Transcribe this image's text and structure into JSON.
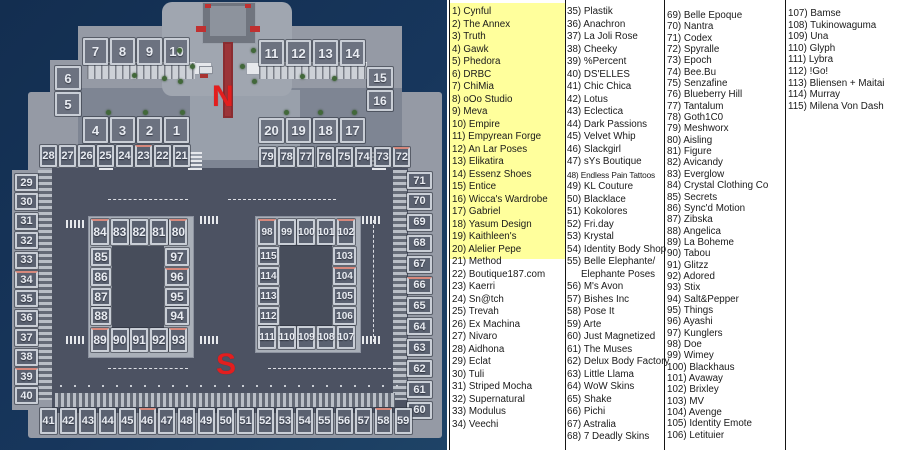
{
  "colors": {
    "water": "#16365c",
    "platform": "#959aa5",
    "road": "#4c5262",
    "plot_fill": "#5a6170",
    "plot_border": "#c9ced6",
    "plot_text": "#e9ecf2",
    "accent_salmon": "#d6887c",
    "highlight_yellow": "#ffff9c",
    "label_red": "#e31e1e",
    "panel_bg": "#ffffff",
    "text": "#1a1a1a"
  },
  "map": {
    "north_label": "N",
    "south_label": "S",
    "plot_groups": [
      {
        "nums": [
          "7",
          "8",
          "9",
          "10"
        ],
        "x": 83,
        "y": 38,
        "dx": 27,
        "w": 25,
        "h": 27,
        "fs": 13,
        "fill": "#6c7280"
      },
      {
        "nums": [
          "11",
          "12",
          "13",
          "14"
        ],
        "x": 259,
        "y": 40,
        "dx": 27,
        "w": 25,
        "h": 26,
        "fs": 13,
        "fill": "#6c7280"
      },
      {
        "nums": [
          "6",
          "5"
        ],
        "x": 55,
        "y": 66,
        "dy": 26,
        "w": 26,
        "h": 24,
        "fs": 13,
        "fill": "#6c7280"
      },
      {
        "nums": [
          "15",
          "16"
        ],
        "x": 367,
        "y": 67,
        "dy": 23,
        "w": 26,
        "h": 21,
        "fs": 12,
        "fill": "#6c7280"
      },
      {
        "nums": [
          "4",
          "3",
          "2",
          "1"
        ],
        "x": 83,
        "y": 117,
        "dx": 27,
        "w": 25,
        "h": 26,
        "fs": 13,
        "fill": "#6c7280"
      },
      {
        "nums": [
          "20",
          "19",
          "18",
          "17"
        ],
        "x": 259,
        "y": 118,
        "dx": 27,
        "w": 25,
        "h": 25,
        "fs": 13,
        "fill": "#6c7280"
      },
      {
        "nums": [
          "28",
          "27",
          "26",
          "25",
          "24",
          "23",
          "22",
          "21"
        ],
        "x": 40,
        "y": 145,
        "dx": 19,
        "w": 17,
        "h": 22,
        "fs": 11
      },
      {
        "nums": [
          "79",
          "78",
          "77",
          "76",
          "75",
          "74",
          "73",
          "72"
        ],
        "x": 259,
        "y": 147,
        "dx": 19.2,
        "w": 17,
        "h": 20,
        "fs": 11
      },
      {
        "nums": [
          "29",
          "30",
          "31",
          "32",
          "33",
          "34",
          "35",
          "36",
          "37",
          "38",
          "39",
          "40"
        ],
        "x": 15,
        "y": 174,
        "dy": 19.4,
        "w": 23,
        "h": 17,
        "fs": 11
      },
      {
        "nums": [
          "71",
          "70",
          "69",
          "68",
          "67",
          "66",
          "65",
          "64",
          "63",
          "62",
          "61",
          "60"
        ],
        "x": 407,
        "y": 172,
        "dy": 20.9,
        "w": 25,
        "h": 17,
        "fs": 11
      },
      {
        "nums": [
          "41",
          "42",
          "43",
          "44",
          "45",
          "46",
          "47",
          "48",
          "49",
          "50",
          "51",
          "52",
          "53",
          "54",
          "55",
          "56",
          "57",
          "58",
          "59"
        ],
        "x": 40,
        "y": 408,
        "dx": 19.7,
        "w": 17,
        "h": 26,
        "fs": 11
      },
      {
        "nums": [
          "84",
          "83",
          "82",
          "81",
          "80"
        ],
        "x": 91,
        "y": 219,
        "dx": 19.6,
        "w": 18,
        "h": 26,
        "fs": 12
      },
      {
        "nums": [
          "85",
          "86",
          "87",
          "88"
        ],
        "x": 91,
        "y": 248,
        "dy": 19.8,
        "w": 20,
        "h": 18,
        "fs": 12
      },
      {
        "nums": [
          "97",
          "96",
          "95",
          "94"
        ],
        "x": 165,
        "y": 248,
        "dy": 19.8,
        "w": 24,
        "h": 18,
        "fs": 12
      },
      {
        "nums": [
          "89",
          "90",
          "91",
          "92",
          "93"
        ],
        "x": 91,
        "y": 328,
        "dx": 19.6,
        "w": 18,
        "h": 24,
        "fs": 12
      },
      {
        "nums": [
          "98",
          "99",
          "100",
          "101",
          "102"
        ],
        "x": 258,
        "y": 219,
        "dx": 19.7,
        "w": 18,
        "h": 26,
        "fs": 10
      },
      {
        "nums": [
          "115",
          "114",
          "113",
          "112"
        ],
        "x": 258,
        "y": 247,
        "dy": 20,
        "w": 21,
        "h": 18,
        "fs": 10
      },
      {
        "nums": [
          "103",
          "104",
          "105",
          "106"
        ],
        "x": 333,
        "y": 247,
        "dy": 20,
        "w": 23,
        "h": 18,
        "fs": 10
      },
      {
        "nums": [
          "111",
          "110",
          "109",
          "108",
          "107"
        ],
        "x": 258,
        "y": 326,
        "dx": 19.7,
        "w": 18,
        "h": 23,
        "fs": 10
      }
    ],
    "accented_plots": [
      "84",
      "80",
      "98",
      "102",
      "89",
      "93",
      "104",
      "96",
      "34",
      "39",
      "23",
      "46",
      "58",
      "66",
      "72"
    ]
  },
  "directory": {
    "highlighted_items": "1-20",
    "columns": [
      {
        "x": 452,
        "cls": "c0",
        "items": [
          {
            "n": "1",
            "t": "Cynful"
          },
          {
            "n": "2",
            "t": "The Annex"
          },
          {
            "n": "3",
            "t": "Truth"
          },
          {
            "n": "4",
            "t": "Gawk"
          },
          {
            "n": "5",
            "t": "Phedora"
          },
          {
            "n": "6",
            "t": "DRBC"
          },
          {
            "n": "7",
            "t": "ChiMia"
          },
          {
            "n": "8",
            "t": "oOo Studio"
          },
          {
            "n": "9",
            "t": "Meva"
          },
          {
            "n": "10",
            "t": "Empire"
          },
          {
            "n": "11",
            "t": "Empyrean Forge"
          },
          {
            "n": "12",
            "t": "An Lar Poses"
          },
          {
            "n": "13",
            "t": "Elikatira"
          },
          {
            "n": "14",
            "t": "Essenz Shoes"
          },
          {
            "n": "15",
            "t": "Entice"
          },
          {
            "n": "16",
            "t": "Wicca's Wardrobe"
          },
          {
            "n": "17",
            "t": "Gabriel"
          },
          {
            "n": "18",
            "t": "Yasum Design"
          },
          {
            "n": "19",
            "t": "Kaithleen's"
          },
          {
            "n": "20",
            "t": "Alelier Pepe"
          },
          {
            "n": "21",
            "t": "Method"
          },
          {
            "n": "22",
            "t": "Boutique187.com"
          },
          {
            "n": "23",
            "t": "Kaerri"
          },
          {
            "n": "24",
            "t": "Sn@tch"
          },
          {
            "n": "25",
            "t": "Trevah"
          },
          {
            "n": "26",
            "t": "Ex Machina"
          },
          {
            "n": "27",
            "t": "Nivaro"
          },
          {
            "n": "28",
            "t": "Aidhona"
          },
          {
            "n": "29",
            "t": "Eclat"
          },
          {
            "n": "30",
            "t": "Tuli"
          },
          {
            "n": "31",
            "t": "Striped Mocha"
          },
          {
            "n": "32",
            "t": "Supernatural"
          },
          {
            "n": "33",
            "t": "Modulus"
          },
          {
            "n": "34",
            "t": "Veechi"
          }
        ]
      },
      {
        "x": 567,
        "cls": "c1",
        "items": [
          {
            "n": "35",
            "t": "Plastik"
          },
          {
            "n": "36",
            "t": "Anachron"
          },
          {
            "n": "37",
            "t": "La Joli Rose"
          },
          {
            "n": "38",
            "t": "Cheeky"
          },
          {
            "n": "39",
            "t": "%Percent"
          },
          {
            "n": "40",
            "t": "DS'ELLES"
          },
          {
            "n": "41",
            "t": "Chic Chica"
          },
          {
            "n": "42",
            "t": "Lotus"
          },
          {
            "n": "43",
            "t": "Eclectica"
          },
          {
            "n": "44",
            "t": "Dark Passions"
          },
          {
            "n": "45",
            "t": "Velvet Whip"
          },
          {
            "n": "46",
            "t": "Slackgirl"
          },
          {
            "n": "47",
            "t": "sYs Boutique"
          },
          {
            "n": "48",
            "t": "Endless Pain Tattoos",
            "small": true
          },
          {
            "n": "49",
            "t": "KL Couture"
          },
          {
            "n": "50",
            "t": "Blacklace"
          },
          {
            "n": "51",
            "t": "Kokolores"
          },
          {
            "n": "52",
            "t": "Fri.day"
          },
          {
            "n": "53",
            "t": "Krystal"
          },
          {
            "n": "54",
            "t": "Identity Body Shop"
          },
          {
            "n": "55",
            "t": "Belle Elephante/",
            "t2": "Elephante Poses"
          },
          {
            "n": "56",
            "t": "M's Avon"
          },
          {
            "n": "57",
            "t": "Bishes Inc"
          },
          {
            "n": "58",
            "t": "Pose It"
          },
          {
            "n": "59",
            "t": "Arte"
          },
          {
            "n": "60",
            "t": "Just Magnetized"
          },
          {
            "n": "61",
            "t": "The Muses"
          },
          {
            "n": "62",
            "t": "Delux Body Factory"
          },
          {
            "n": "63",
            "t": "Little Llama"
          },
          {
            "n": "64",
            "t": "WoW Skins"
          },
          {
            "n": "65",
            "t": "Shake"
          },
          {
            "n": "66",
            "t": "Pichi"
          },
          {
            "n": "67",
            "t": "Astralia"
          },
          {
            "n": "68",
            "t": "7 Deadly Skins"
          }
        ]
      },
      {
        "x": 667,
        "cls": "c2",
        "items": [
          {
            "n": "69",
            "t": "Belle Epoque"
          },
          {
            "n": "70",
            "t": "Nantra"
          },
          {
            "n": "71",
            "t": "Codex"
          },
          {
            "n": "72",
            "t": "Spyralle"
          },
          {
            "n": "73",
            "t": "Epoch"
          },
          {
            "n": "74",
            "t": "Bee.Bu"
          },
          {
            "n": "75",
            "t": "Senzafine"
          },
          {
            "n": "76",
            "t": "Blueberry Hill"
          },
          {
            "n": "77",
            "t": "Tantalum"
          },
          {
            "n": "78",
            "t": "Goth1C0"
          },
          {
            "n": "79",
            "t": "Meshworx"
          },
          {
            "n": "80",
            "t": "Aisling"
          },
          {
            "n": "81",
            "t": "Figure"
          },
          {
            "n": "82",
            "t": "Avicandy"
          },
          {
            "n": "83",
            "t": "Everglow"
          },
          {
            "n": "84",
            "t": "Crystal Clothing Co"
          },
          {
            "n": "85",
            "t": "Secrets"
          },
          {
            "n": "86",
            "t": "Sync'd Motion"
          },
          {
            "n": "87",
            "t": "Zibska"
          },
          {
            "n": "88",
            "t": "Angelica"
          },
          {
            "n": "89",
            "t": "La Boheme"
          },
          {
            "n": "90",
            "t": "Tabou"
          },
          {
            "n": "91",
            "t": "Glitzz"
          },
          {
            "n": "92",
            "t": "Adored"
          },
          {
            "n": "93",
            "t": "Stix"
          },
          {
            "n": "94",
            "t": "Salt&Pepper"
          },
          {
            "n": "95",
            "t": "Things"
          },
          {
            "n": "96",
            "t": "Ayashi"
          },
          {
            "n": "97",
            "t": "Kunglers"
          },
          {
            "n": "98",
            "t": "Doe"
          },
          {
            "n": "99",
            "t": "Wimey"
          },
          {
            "n": "100",
            "t": "Blackhaus"
          },
          {
            "n": "101",
            "t": "Avaway"
          },
          {
            "n": "102",
            "t": "Brixley"
          },
          {
            "n": "103",
            "t": "MV"
          },
          {
            "n": "104",
            "t": "Avenge"
          },
          {
            "n": "105",
            "t": "Identity Emote"
          },
          {
            "n": "106",
            "t": "Letituier"
          }
        ]
      },
      {
        "x": 788,
        "cls": "c3",
        "items": [
          {
            "n": "107",
            "t": "Bamse"
          },
          {
            "n": "108",
            "t": "Tukinowaguma"
          },
          {
            "n": "109",
            "t": "Una"
          },
          {
            "n": "110",
            "t": "Glyph"
          },
          {
            "n": "111",
            "t": "Lybra"
          },
          {
            "n": "112",
            "t": "!Go!"
          },
          {
            "n": "113",
            "t": "Bliensen + Maitai"
          },
          {
            "n": "114",
            "t": "Murray"
          },
          {
            "n": "115",
            "t": "Milena Von Dash"
          }
        ]
      }
    ]
  }
}
